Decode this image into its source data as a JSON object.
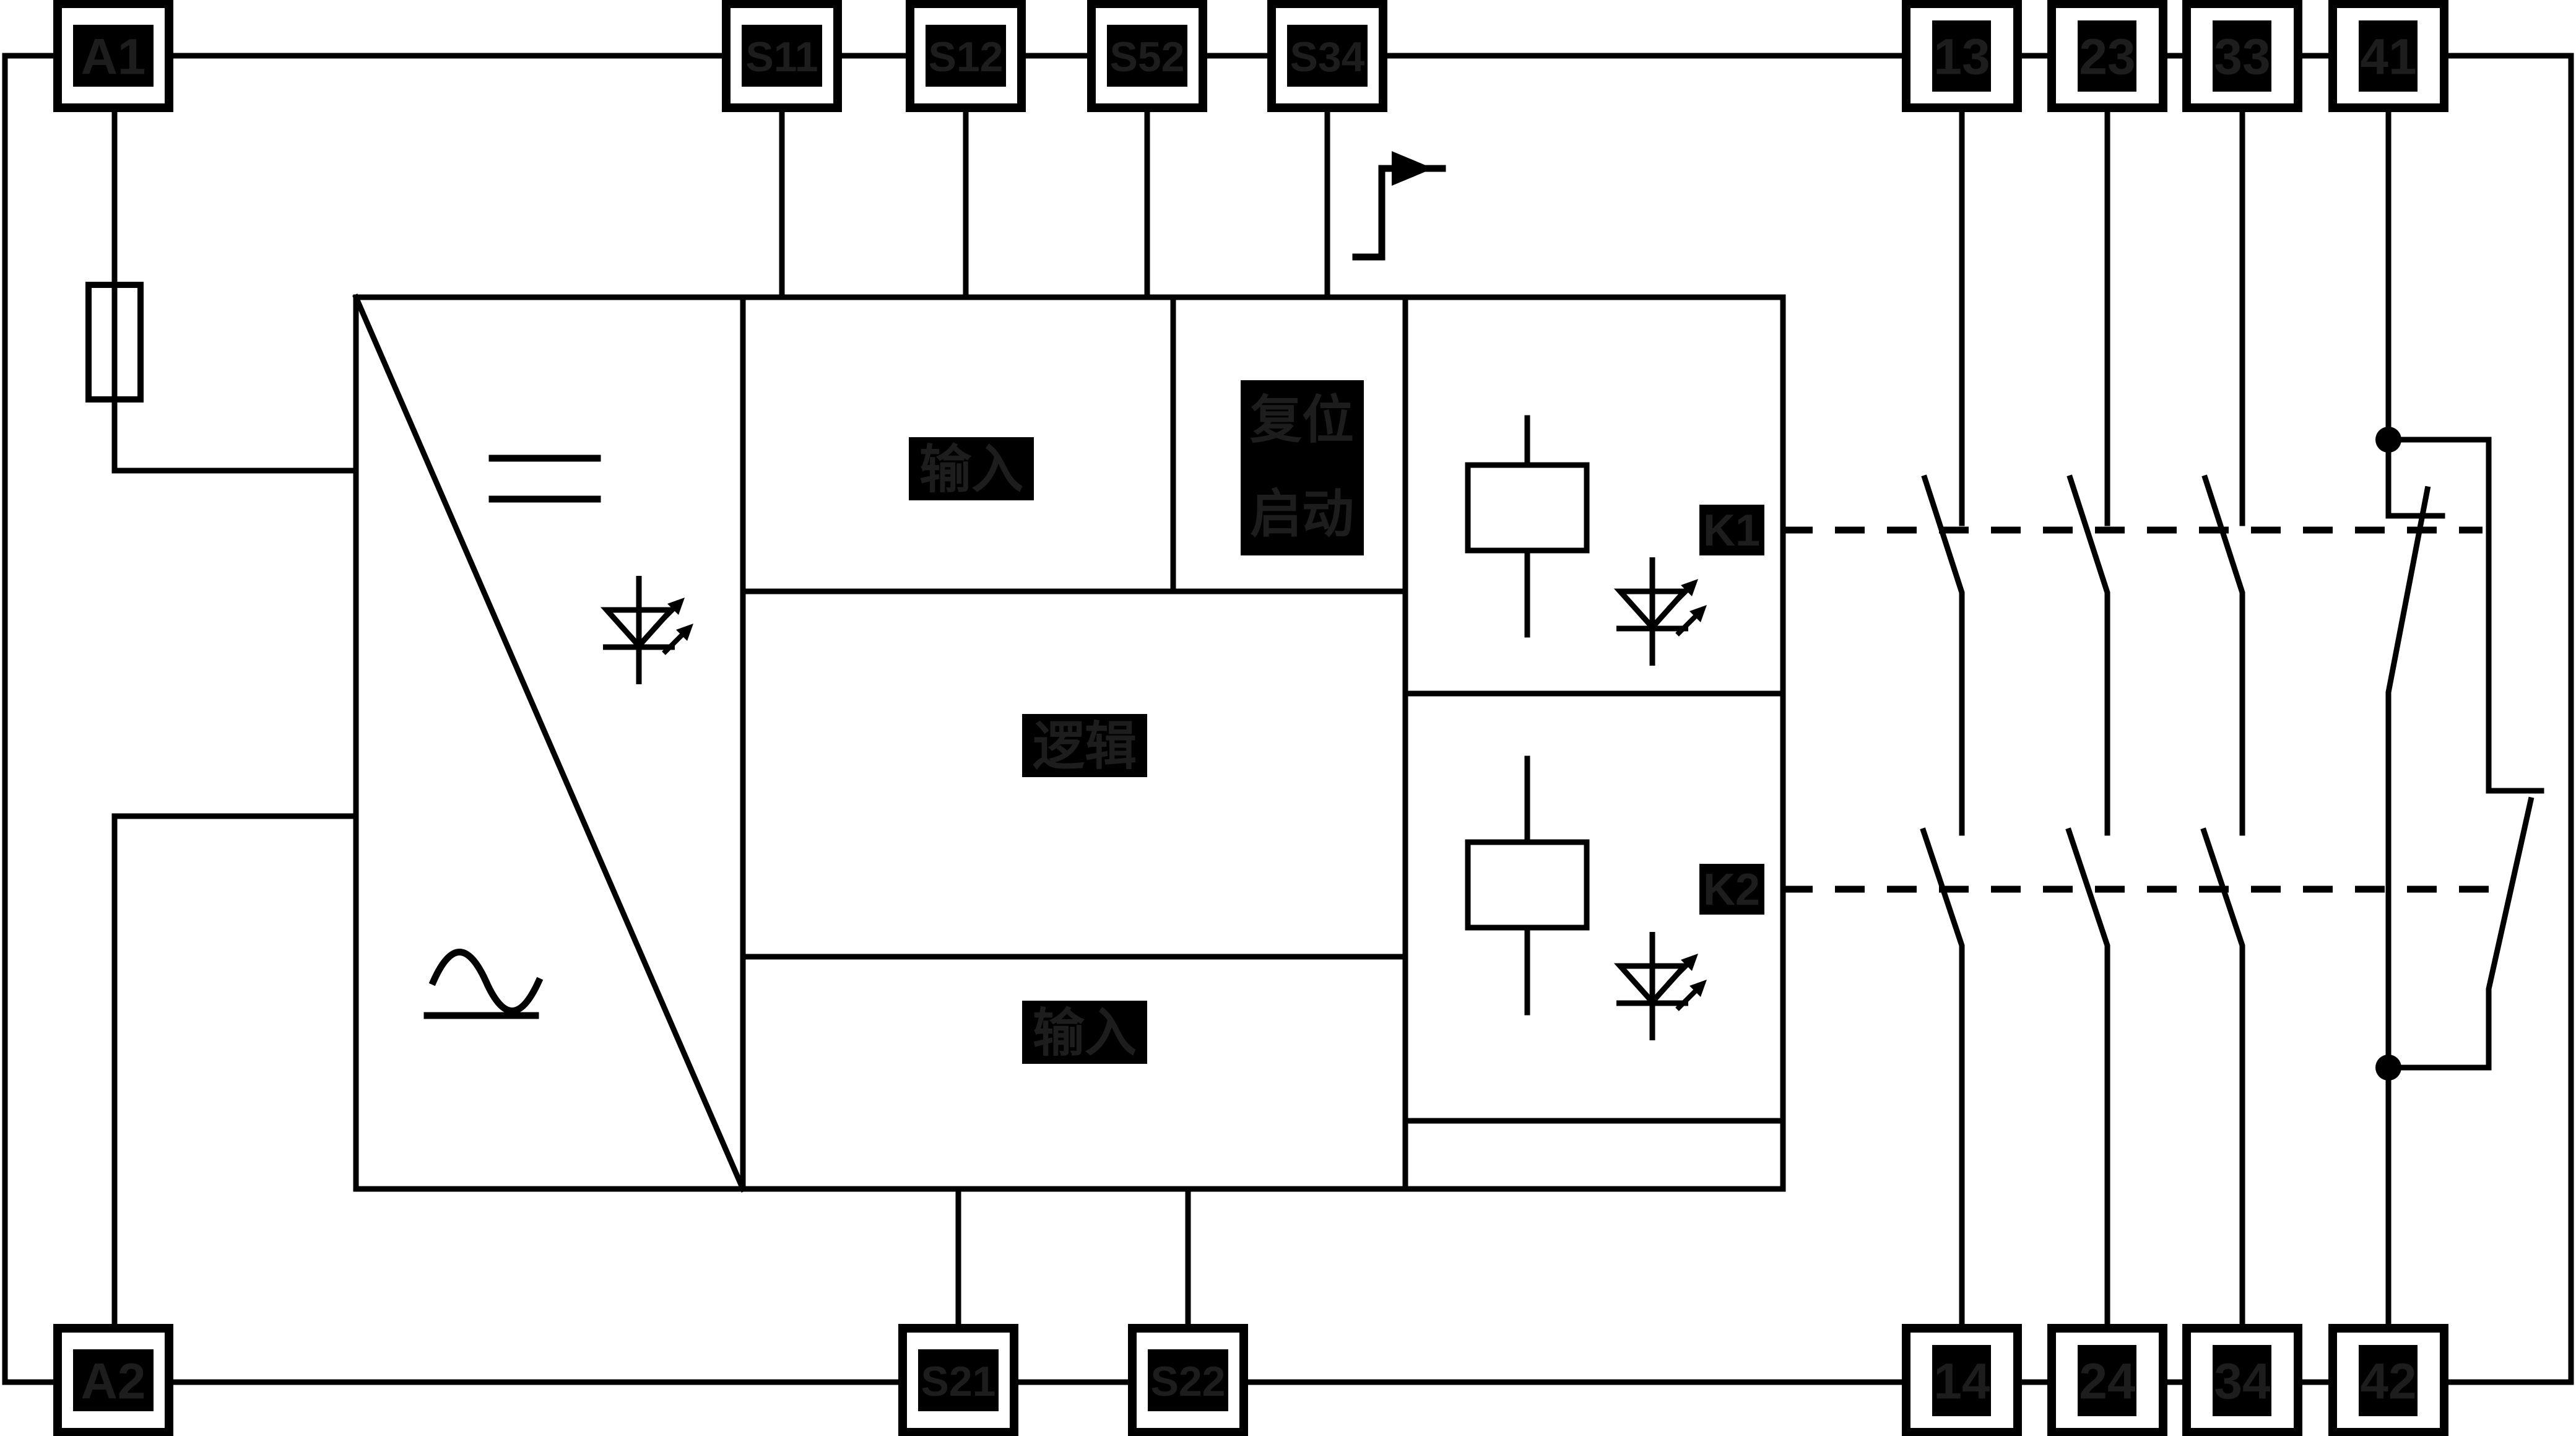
{
  "colors": {
    "background": "#ffffff",
    "line": "#000000",
    "chip_background": "#000000",
    "chip_text": "#1d1d1d"
  },
  "icons": {
    "dc-symbol-icon": "=",
    "ac-symbol-icon": "∿",
    "led-icon": "diode-with-emission-arrows",
    "fuse-icon": "rectangle-on-wire",
    "relay-coil": "rectangle-with-leads",
    "reset-flag-icon": "rising-edge-flag-arrow",
    "junction-dot": "filled-circle",
    "no-contact": "normally-open-switch",
    "nc-contact": "normally-closed-switch"
  },
  "terminals": {
    "top": [
      {
        "label": "A1"
      },
      {
        "label": "S11"
      },
      {
        "label": "S12"
      },
      {
        "label": "S52"
      },
      {
        "label": "S34"
      },
      {
        "label": "13"
      },
      {
        "label": "23"
      },
      {
        "label": "33"
      },
      {
        "label": "41"
      }
    ],
    "bottom": [
      {
        "label": "A2"
      },
      {
        "label": "S21"
      },
      {
        "label": "S22"
      },
      {
        "label": "14"
      },
      {
        "label": "24"
      },
      {
        "label": "34"
      },
      {
        "label": "42"
      }
    ]
  },
  "blocks": {
    "input_top": {
      "label": "输入"
    },
    "reset_start": {
      "line1": "复位",
      "line2": "启动"
    },
    "logic": {
      "label": "逻辑"
    },
    "input_bottom": {
      "label": "输入"
    },
    "relay1": {
      "label": "K1"
    },
    "relay2": {
      "label": "K2"
    }
  }
}
